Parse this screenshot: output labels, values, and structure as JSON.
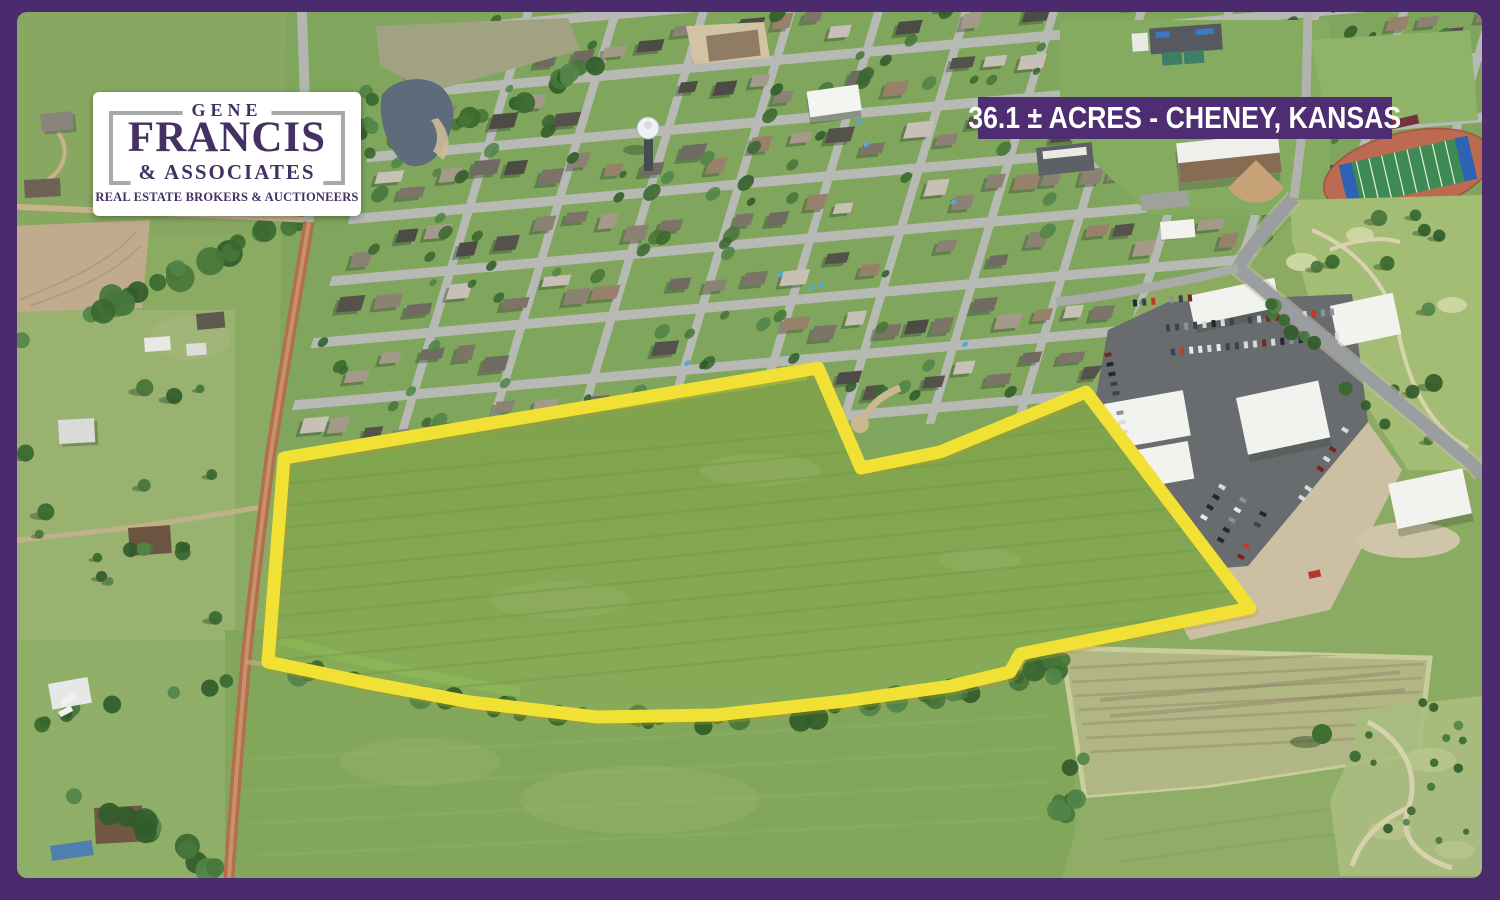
{
  "banner": {
    "label": "36.1 ± ACRES - CHENEY, KANSAS",
    "bg": "#4f2d73",
    "fg": "#ffffff"
  },
  "logo": {
    "top": "GENE",
    "name": "FRANCIS",
    "sub": "& ASSOCIATES",
    "tagline": "REAL ESTATE BROKERS & AUCTIONEERS",
    "text_color": "#443061",
    "frame_color": "#a8a8a8",
    "bg": "#ffffff"
  },
  "frame": {
    "color": "#4b2a6e"
  },
  "property": {
    "outline_color": "#f2e135",
    "outline_points": "268,662 284,458 818,368 861,468 940,452 1086,392 1250,608 1020,654 1010,672 951,686 845,701 716,715 597,717 470,702 368,683"
  },
  "scene": {
    "field_green": "#7fa24b",
    "field_green_light": "#93c24d",
    "pasture": "#93b06c",
    "town_lawn": "#7fa65c",
    "street": "#b7bab4",
    "dirt_road": "#b06f4e",
    "parking": "#686c6f",
    "building_white": "#f2f2ef",
    "water": "#5d6b7a",
    "track_red": "#bc6a52",
    "turf_green": "#3f8a52",
    "hay_field": "#b3b787",
    "roof_palette": [
      "#6f6b62",
      "#7d7468",
      "#55524c",
      "#8c8274",
      "#a39a8a",
      "#c6c0b6",
      "#4d4b45",
      "#97816b"
    ]
  }
}
